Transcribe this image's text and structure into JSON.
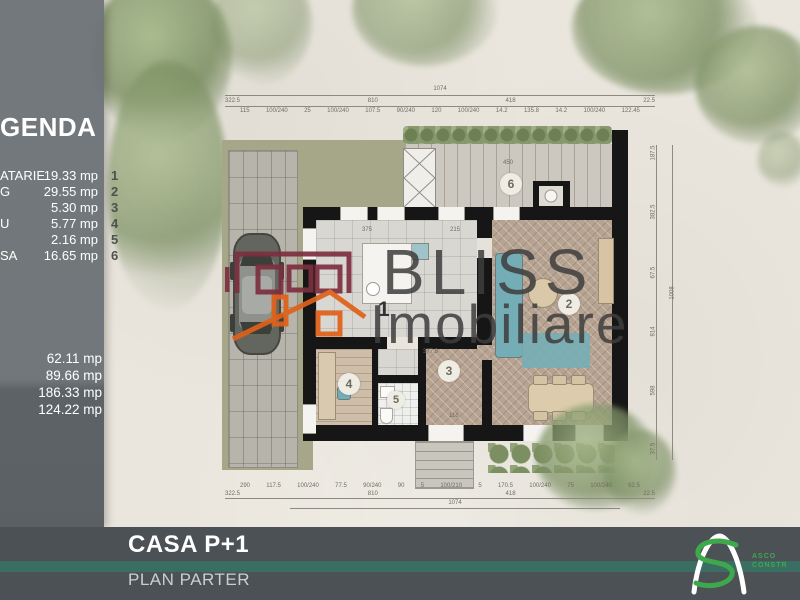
{
  "legend": {
    "title": "GENDA",
    "rows": [
      {
        "label": "ATARIE",
        "value": "19.33 mp",
        "num": "1"
      },
      {
        "label": "G",
        "value": "29.55 mp",
        "num": "2"
      },
      {
        "label": "",
        "value": "5.30 mp",
        "num": "3"
      },
      {
        "label": "U",
        "value": "5.77 mp",
        "num": "4"
      },
      {
        "label": "",
        "value": "2.16 mp",
        "num": "5"
      },
      {
        "label": "SA",
        "value": "16.65 mp",
        "num": "6"
      }
    ],
    "totals": [
      "62.11 mp",
      "89.66 mp",
      "186.33 mp",
      "124.22 mp"
    ]
  },
  "watermark": {
    "line1": "BLISS",
    "line2": "Imobiliare"
  },
  "footer": {
    "title": "CASA P+1",
    "subtitle": "PLAN PARTER",
    "logo_line1": "ASCO",
    "logo_line2": "CONSTR"
  },
  "plan": {
    "room_numbers": [
      "1",
      "2",
      "3",
      "4",
      "5",
      "6"
    ],
    "dims_top_total": "1074",
    "dims_top_mid": [
      "322.5",
      "810",
      "418",
      "22.5"
    ],
    "dims_top_detail": [
      "115",
      "100/240",
      "25",
      "100/240",
      "107.5",
      "90/240",
      "120",
      "100/240",
      "14.2",
      "135.8",
      "14.2",
      "100/240",
      "122.45"
    ],
    "dims_bottom_detail": [
      "290",
      "117.5",
      "100/240",
      "77.5",
      "90/240",
      "90",
      "5",
      "100/210",
      "5",
      "170.5",
      "100/240",
      "75",
      "100/240",
      "62.5"
    ],
    "dims_bottom_mid": [
      "322.5",
      "810",
      "418",
      "22.5"
    ],
    "dims_bottom_total": "1074",
    "dims_right": [
      "187.5",
      "382.5",
      "67.5",
      "814",
      "598",
      "37.5"
    ],
    "dims_right_total": "1008",
    "interior_labels": {
      "kitchen_w": "375",
      "kitchen_r": "215",
      "hall_w": "377.5",
      "porch_w": "118",
      "terrace_w": "450"
    }
  },
  "colors": {
    "panel": "#6e7478",
    "footer": "#4c5156",
    "teal_line": "#3a6e62",
    "logo_green": "#3ea94c",
    "watermark_red": "#7d2f3f",
    "watermark_orange": "#e06018",
    "hedge": "#87986f",
    "lawn": "#a6a689",
    "furniture_teal": "#74adb6"
  }
}
